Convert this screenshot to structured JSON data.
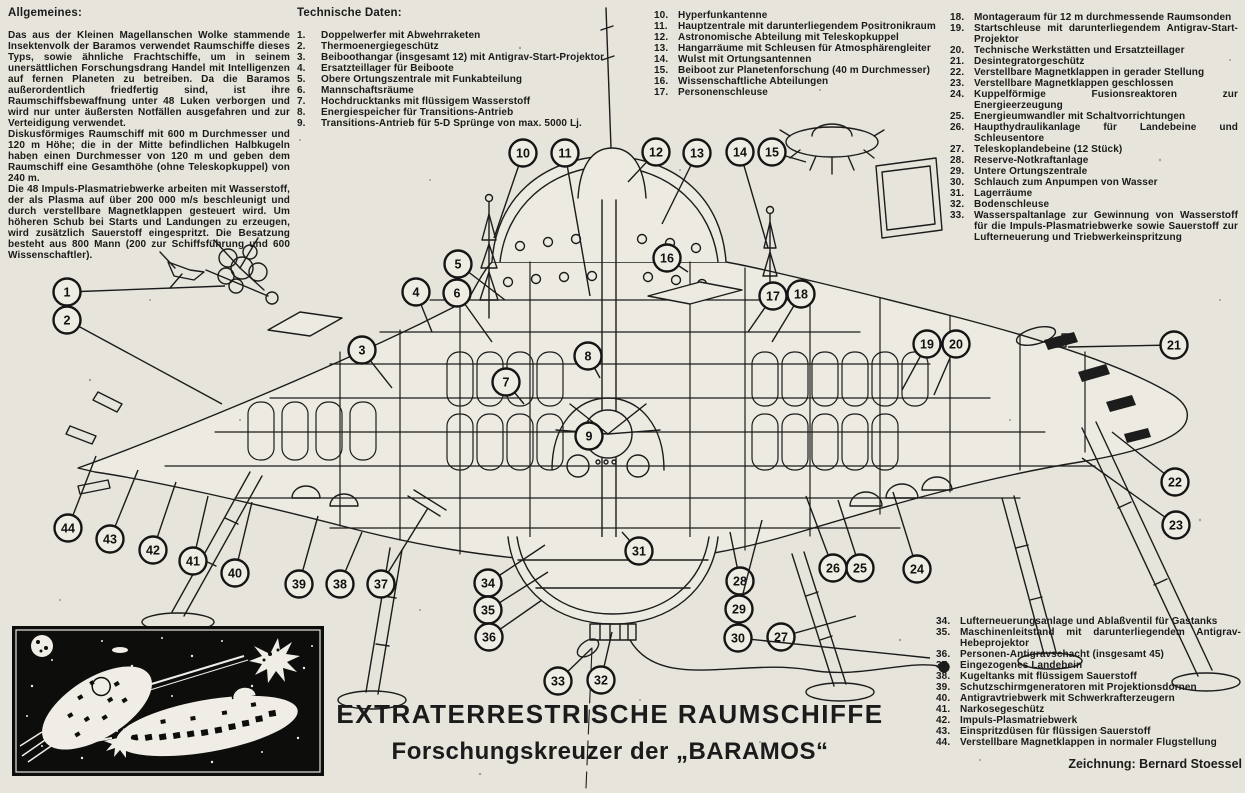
{
  "page": {
    "title_line1": "EXTRATERRESTRISCHE RAUMSCHIFFE",
    "title_line2": "Forschungskreuzer der „BARAMOS“",
    "credit": "Zeichnung: Bernard Stoessel"
  },
  "colors": {
    "paper": "#e7e4db",
    "ink": "#1b1b1b",
    "inset_background": "#0d0d0c",
    "callout_fill": "#efece4"
  },
  "general": {
    "heading": "Allgemeines:",
    "paragraphs": [
      "Das aus der Kleinen Magellanschen Wolke stammende Insektenvolk der Baramos verwendet Raumschiffe dieses Typs, sowie ähnliche Frachtschiffe, um in seinem unersättlichen Forschungsdrang Handel mit Intelligenzen auf fernen Planeten zu betreiben. Da die Baramos außerordentlich friedfertig sind, ist ihre Raumschiffsbewaffnung unter 48 Luken verborgen und wird nur unter äußersten Notfällen ausgefahren und zur Verteidigung verwendet.",
      "Diskusförmiges Raumschiff mit 600 m Durchmesser und 120 m Höhe; die in der Mitte befindlichen Halbkugeln haben einen Durchmesser von 120 m und geben dem Raumschiff eine Gesamthöhe (ohne Teleskopkuppel) von 240 m.",
      "Die 48 Impuls-Plasmatriebwerke arbeiten mit Wasserstoff, der als Plasma auf über 200 000 m/s beschleunigt und durch verstellbare Magnetklappen gesteuert wird. Um höheren Schub bei Starts und Landungen zu erzeugen, wird zusätzlich Sauerstoff eingespritzt. Die Besatzung besteht aus 800 Mann (200 zur Schiffsführung und 600 Wissenschaftler)."
    ]
  },
  "tech_data": {
    "heading": "Technische Daten:",
    "items": [
      {
        "n": "1.",
        "text": "Doppelwerfer mit Abwehrraketen"
      },
      {
        "n": "2.",
        "text": "Thermoenergiegeschütz"
      },
      {
        "n": "3.",
        "text": "Beiboothangar (insgesamt 12) mit Antigrav-Start-Projektor"
      },
      {
        "n": "4.",
        "text": "Ersatzteillager für Beiboote"
      },
      {
        "n": "5.",
        "text": "Obere Ortungszentrale mit Funkabteilung"
      },
      {
        "n": "6.",
        "text": "Mannschaftsräume"
      },
      {
        "n": "7.",
        "text": "Hochdrucktanks mit flüssigem Wasserstoff"
      },
      {
        "n": "8.",
        "text": "Energiespeicher für Transitions-Antrieb"
      },
      {
        "n": "9.",
        "text": "Transitions-Antrieb für 5-D Sprünge von max. 5000 Lj."
      }
    ]
  },
  "legend_top_mid": {
    "items": [
      {
        "n": "10.",
        "text": "Hyperfunkantenne"
      },
      {
        "n": "11.",
        "text": "Hauptzentrale mit darunterliegendem Positronikraum"
      },
      {
        "n": "12.",
        "text": "Astronomische Abteilung mit Teleskopkuppel"
      },
      {
        "n": "13.",
        "text": "Hangarräume mit Schleusen für Atmosphärengleiter"
      },
      {
        "n": "14.",
        "text": "Wulst mit Ortungsantennen"
      },
      {
        "n": "15.",
        "text": "Beiboot zur Planetenforschung (40 m Durchmesser)"
      },
      {
        "n": "16.",
        "text": "Wissenschaftliche Abteilungen"
      },
      {
        "n": "17.",
        "text": "Personenschleuse"
      }
    ]
  },
  "legend_top_right": {
    "items": [
      {
        "n": "18.",
        "text": "Montageraum für 12 m durchmessende Raumsonden"
      },
      {
        "n": "19.",
        "text": "Startschleuse mit darunterliegendem Antigrav-Start-Projektor"
      },
      {
        "n": "20.",
        "text": "Technische Werkstätten und Ersatzteillager"
      },
      {
        "n": "21.",
        "text": "Desintegratorgeschütz"
      },
      {
        "n": "22.",
        "text": "Verstellbare Magnetklappen in gerader Stellung"
      },
      {
        "n": "23.",
        "text": "Verstellbare Magnetklappen geschlossen"
      },
      {
        "n": "24.",
        "text": "Kuppelförmige Fusionsreaktoren zur Energieerzeugung"
      },
      {
        "n": "25.",
        "text": "Energieumwandler mit Schaltvorrichtungen"
      },
      {
        "n": "26.",
        "text": "Haupthydraulikanlage für Landebeine und Schleusentore"
      },
      {
        "n": "27.",
        "text": "Teleskoplandebeine (12 Stück)"
      },
      {
        "n": "28.",
        "text": "Reserve-Notkraftanlage"
      },
      {
        "n": "29.",
        "text": "Untere Ortungszentrale"
      },
      {
        "n": "30.",
        "text": "Schlauch zum Anpumpen von Wasser"
      },
      {
        "n": "31.",
        "text": "Lagerräume"
      },
      {
        "n": "32.",
        "text": "Bodenschleuse"
      },
      {
        "n": "33.",
        "text": "Wasserspaltanlage zur Gewinnung von Wasserstoff für die Impuls-Plasmatriebwerke sowie Sauerstoff zur Lufterneuerung und Triebwerkeinspritzung"
      }
    ]
  },
  "legend_bottom_right": {
    "items": [
      {
        "n": "34.",
        "text": "Lufterneuerungsanlage und Ablaßventil für Gastanks"
      },
      {
        "n": "35.",
        "text": "Maschinenleitstand mit darunterliegendem Antigrav-Hebeprojektor"
      },
      {
        "n": "36.",
        "text": "Personen-Antigravschacht (insgesamt 45)"
      },
      {
        "n": "37.",
        "text": "Eingezogenes Landebein"
      },
      {
        "n": "38.",
        "text": "Kugeltanks mit flüssigem Sauerstoff"
      },
      {
        "n": "39.",
        "text": "Schutzschirmgeneratoren mit Projektionsdornen"
      },
      {
        "n": "40.",
        "text": "Antigravtriebwerk mit Schwerkrafterzeugern"
      },
      {
        "n": "41.",
        "text": "Narkosegeschütz"
      },
      {
        "n": "42.",
        "text": "Impuls-Plasmatriebwerk"
      },
      {
        "n": "43.",
        "text": "Einspritzdüsen für flüssigen Sauerstoff"
      },
      {
        "n": "44.",
        "text": "Verstellbare Magnetklappen in normaler Flugstellung"
      }
    ]
  },
  "callouts": [
    {
      "n": "1",
      "x": 67,
      "y": 292,
      "tx": 225,
      "ty": 286
    },
    {
      "n": "2",
      "x": 67,
      "y": 320,
      "tx": 222,
      "ty": 404
    },
    {
      "n": "3",
      "x": 362,
      "y": 350,
      "tx": 392,
      "ty": 388
    },
    {
      "n": "4",
      "x": 416,
      "y": 292,
      "tx": 432,
      "ty": 332
    },
    {
      "n": "5",
      "x": 458,
      "y": 264,
      "tx": 505,
      "ty": 300
    },
    {
      "n": "6",
      "x": 457,
      "y": 293,
      "tx": 492,
      "ty": 342
    },
    {
      "n": "7",
      "x": 506,
      "y": 382,
      "tx": 524,
      "ty": 404
    },
    {
      "n": "8",
      "x": 588,
      "y": 356,
      "tx": 600,
      "ty": 378
    },
    {
      "n": "9",
      "x": 589,
      "y": 436,
      "tx": 598,
      "ty": 448
    },
    {
      "n": "10",
      "x": 523,
      "y": 153,
      "tx": 494,
      "ty": 238
    },
    {
      "n": "11",
      "x": 565,
      "y": 153,
      "tx": 590,
      "ty": 296
    },
    {
      "n": "12",
      "x": 656,
      "y": 152,
      "tx": 628,
      "ty": 182
    },
    {
      "n": "13",
      "x": 697,
      "y": 153,
      "tx": 662,
      "ty": 224
    },
    {
      "n": "14",
      "x": 740,
      "y": 152,
      "tx": 768,
      "ty": 248
    },
    {
      "n": "15",
      "x": 772,
      "y": 152,
      "tx": 806,
      "ty": 162
    },
    {
      "n": "16",
      "x": 667,
      "y": 258,
      "tx": 688,
      "ty": 272
    },
    {
      "n": "17",
      "x": 773,
      "y": 296,
      "tx": 748,
      "ty": 332
    },
    {
      "n": "18",
      "x": 801,
      "y": 294,
      "tx": 772,
      "ty": 342
    },
    {
      "n": "19",
      "x": 927,
      "y": 344,
      "tx": 902,
      "ty": 390
    },
    {
      "n": "20",
      "x": 956,
      "y": 344,
      "tx": 934,
      "ty": 395
    },
    {
      "n": "21",
      "x": 1174,
      "y": 345,
      "tx": 1068,
      "ty": 347
    },
    {
      "n": "22",
      "x": 1175,
      "y": 482,
      "tx": 1112,
      "ty": 432
    },
    {
      "n": "23",
      "x": 1176,
      "y": 525,
      "tx": 1082,
      "ty": 458
    },
    {
      "n": "24",
      "x": 917,
      "y": 569,
      "tx": 893,
      "ty": 492
    },
    {
      "n": "25",
      "x": 860,
      "y": 568,
      "tx": 838,
      "ty": 500
    },
    {
      "n": "26",
      "x": 833,
      "y": 568,
      "tx": 806,
      "ty": 496
    },
    {
      "n": "27",
      "x": 781,
      "y": 637,
      "tx": 856,
      "ty": 616
    },
    {
      "n": "28",
      "x": 740,
      "y": 581,
      "tx": 730,
      "ty": 532
    },
    {
      "n": "29",
      "x": 739,
      "y": 609,
      "tx": 762,
      "ty": 520
    },
    {
      "n": "30",
      "x": 738,
      "y": 638,
      "tx": 930,
      "ty": 658
    },
    {
      "n": "31",
      "x": 639,
      "y": 551,
      "tx": 622,
      "ty": 532
    },
    {
      "n": "32",
      "x": 601,
      "y": 680,
      "tx": 612,
      "ty": 632
    },
    {
      "n": "33",
      "x": 558,
      "y": 681,
      "tx": 592,
      "ty": 648
    },
    {
      "n": "34",
      "x": 488,
      "y": 583,
      "tx": 545,
      "ty": 545
    },
    {
      "n": "35",
      "x": 488,
      "y": 610,
      "tx": 548,
      "ty": 572
    },
    {
      "n": "36",
      "x": 489,
      "y": 637,
      "tx": 542,
      "ty": 600
    },
    {
      "n": "37",
      "x": 381,
      "y": 584,
      "tx": 428,
      "ty": 508
    },
    {
      "n": "38",
      "x": 340,
      "y": 584,
      "tx": 362,
      "ty": 532
    },
    {
      "n": "39",
      "x": 299,
      "y": 584,
      "tx": 318,
      "ty": 516
    },
    {
      "n": "40",
      "x": 235,
      "y": 573,
      "tx": 252,
      "ty": 502
    },
    {
      "n": "41",
      "x": 193,
      "y": 561,
      "tx": 208,
      "ty": 496
    },
    {
      "n": "42",
      "x": 153,
      "y": 550,
      "tx": 176,
      "ty": 482
    },
    {
      "n": "43",
      "x": 110,
      "y": 539,
      "tx": 138,
      "ty": 470
    },
    {
      "n": "44",
      "x": 68,
      "y": 528,
      "tx": 96,
      "ty": 456
    }
  ]
}
